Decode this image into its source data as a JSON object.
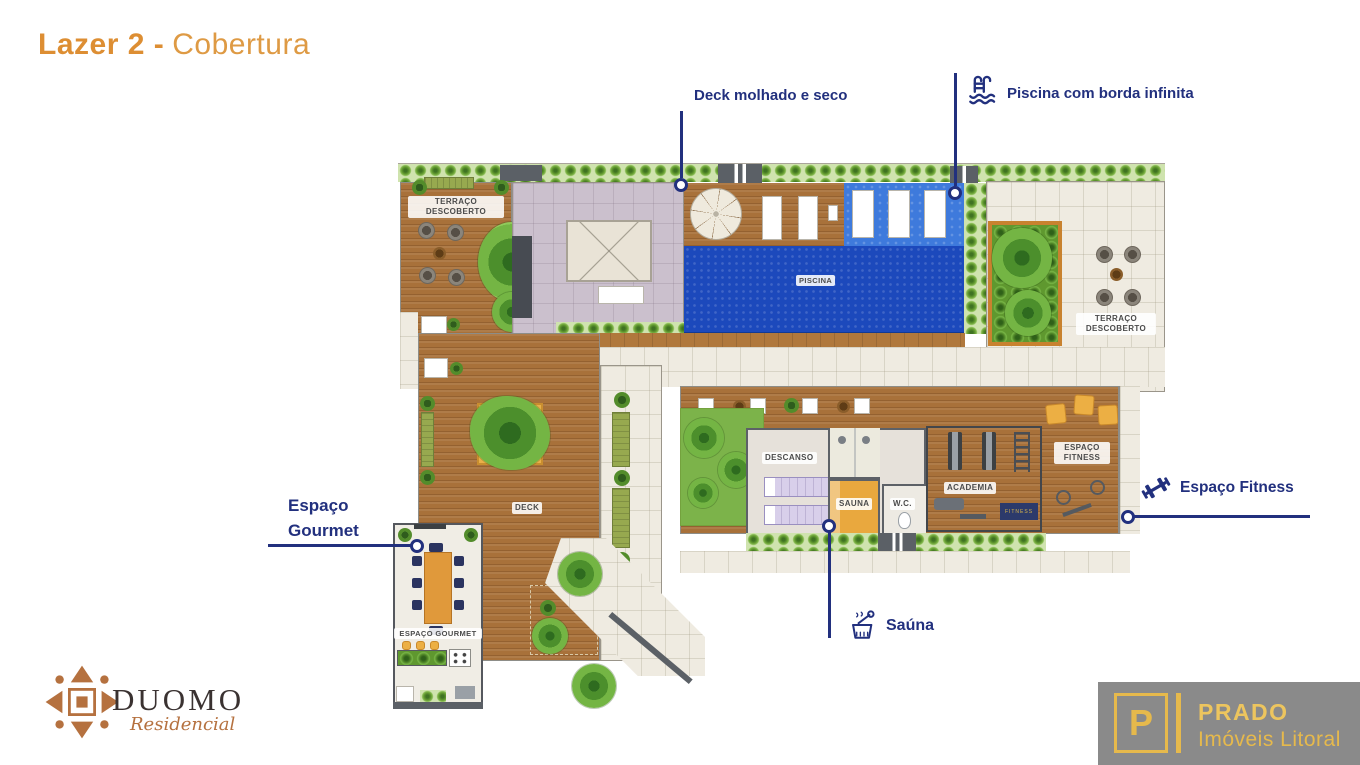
{
  "title": {
    "lead": "Lazer 2 -",
    "rest": "Cobertura"
  },
  "callouts": {
    "deck": {
      "label": "Deck molhado e seco"
    },
    "pool": {
      "label": "Piscina com borda infinita",
      "icon": "pool-ladder-icon"
    },
    "gourmet": {
      "line1": "Espaço",
      "line2": "Gourmet"
    },
    "fitness": {
      "label": "Espaço Fitness",
      "icon": "dumbbell-icon"
    },
    "sauna": {
      "label": "Saúna",
      "icon": "sauna-bucket-icon"
    }
  },
  "rooms": {
    "terraco_left": {
      "line1": "TERRAÇO",
      "line2": "DESCOBERTO"
    },
    "piscina": "PISCINA",
    "terraco_right": {
      "line1": "TERRAÇO",
      "line2": "DESCOBERTO"
    },
    "descanso": "DESCANSO",
    "sauna": "SAUNA",
    "wc": "W.C.",
    "academia": "ACADEMIA",
    "espaco_fitness": {
      "line1": "ESPAÇO",
      "line2": "FITNESS"
    },
    "fitness_mat": "FITNESS",
    "deck": "DECK",
    "espaco_gourmet": "ESPAÇO GOURMET"
  },
  "branding": {
    "duomo": {
      "name": "DUOMO",
      "subtitle": "Residencial"
    },
    "prado": {
      "monogram": "P",
      "name": "PRADO",
      "subtitle": "Imóveis Litoral"
    }
  },
  "colors": {
    "title_orange": "#DD8E33",
    "callout_navy": "#22307E",
    "pool_blue": "#1C49BC",
    "wet_deck_blue": "#3E7ADC",
    "wood_brown": "#A8713A",
    "hedge_green": "#61982F",
    "tile_beige": "#EFEBE1",
    "sauna_amber": "#E9A83E",
    "logo_gold": "#E6B94C",
    "logo_panel_gray": "#8A8A8A",
    "duomo_copper": "#B5713F"
  }
}
